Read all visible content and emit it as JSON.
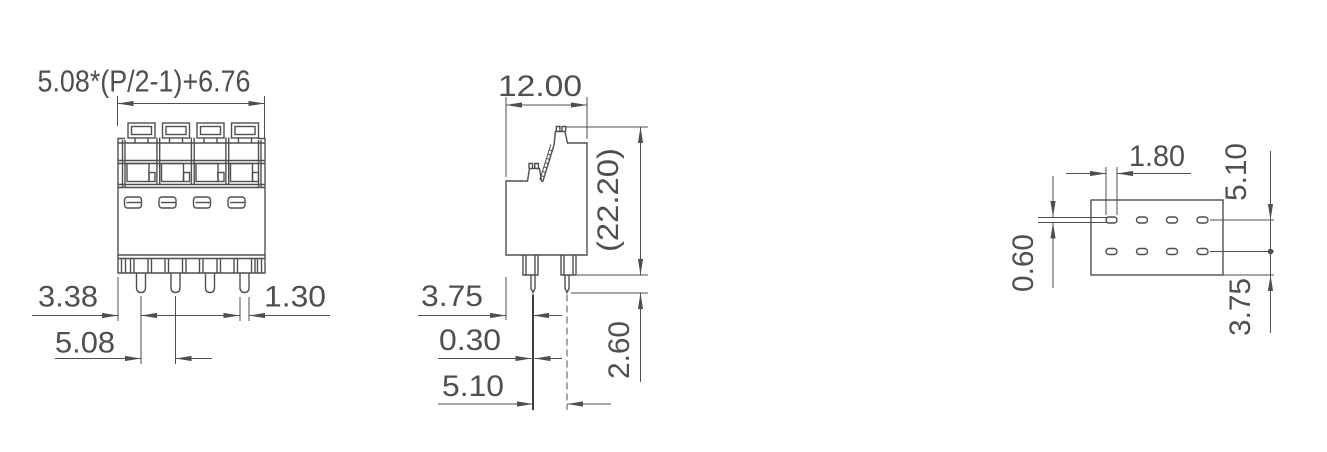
{
  "meta": {
    "drawing_type": "terminal-block-dimension-drawing",
    "line_color": "#4f4f4f",
    "background_color": "#ffffff"
  },
  "front_view": {
    "dims": {
      "pitch_formula": "5.08*(P/2-1)+6.76",
      "left_pin_offset": "3.38",
      "pin_width": "1.30",
      "pin_pitch": "5.08"
    }
  },
  "side_view": {
    "dims": {
      "body_width": "12.00",
      "overall_height": "(22.20)",
      "left_pin_offset": "3.75",
      "pin_thickness": "0.30",
      "pin_spacing": "5.10",
      "pin_protrusion": "2.60"
    }
  },
  "footprint_view": {
    "dims": {
      "hole_slot_width": "1.80",
      "row_pitch": "5.10",
      "hole_slot_height": "0.60",
      "row_edge_offset": "3.75"
    }
  }
}
